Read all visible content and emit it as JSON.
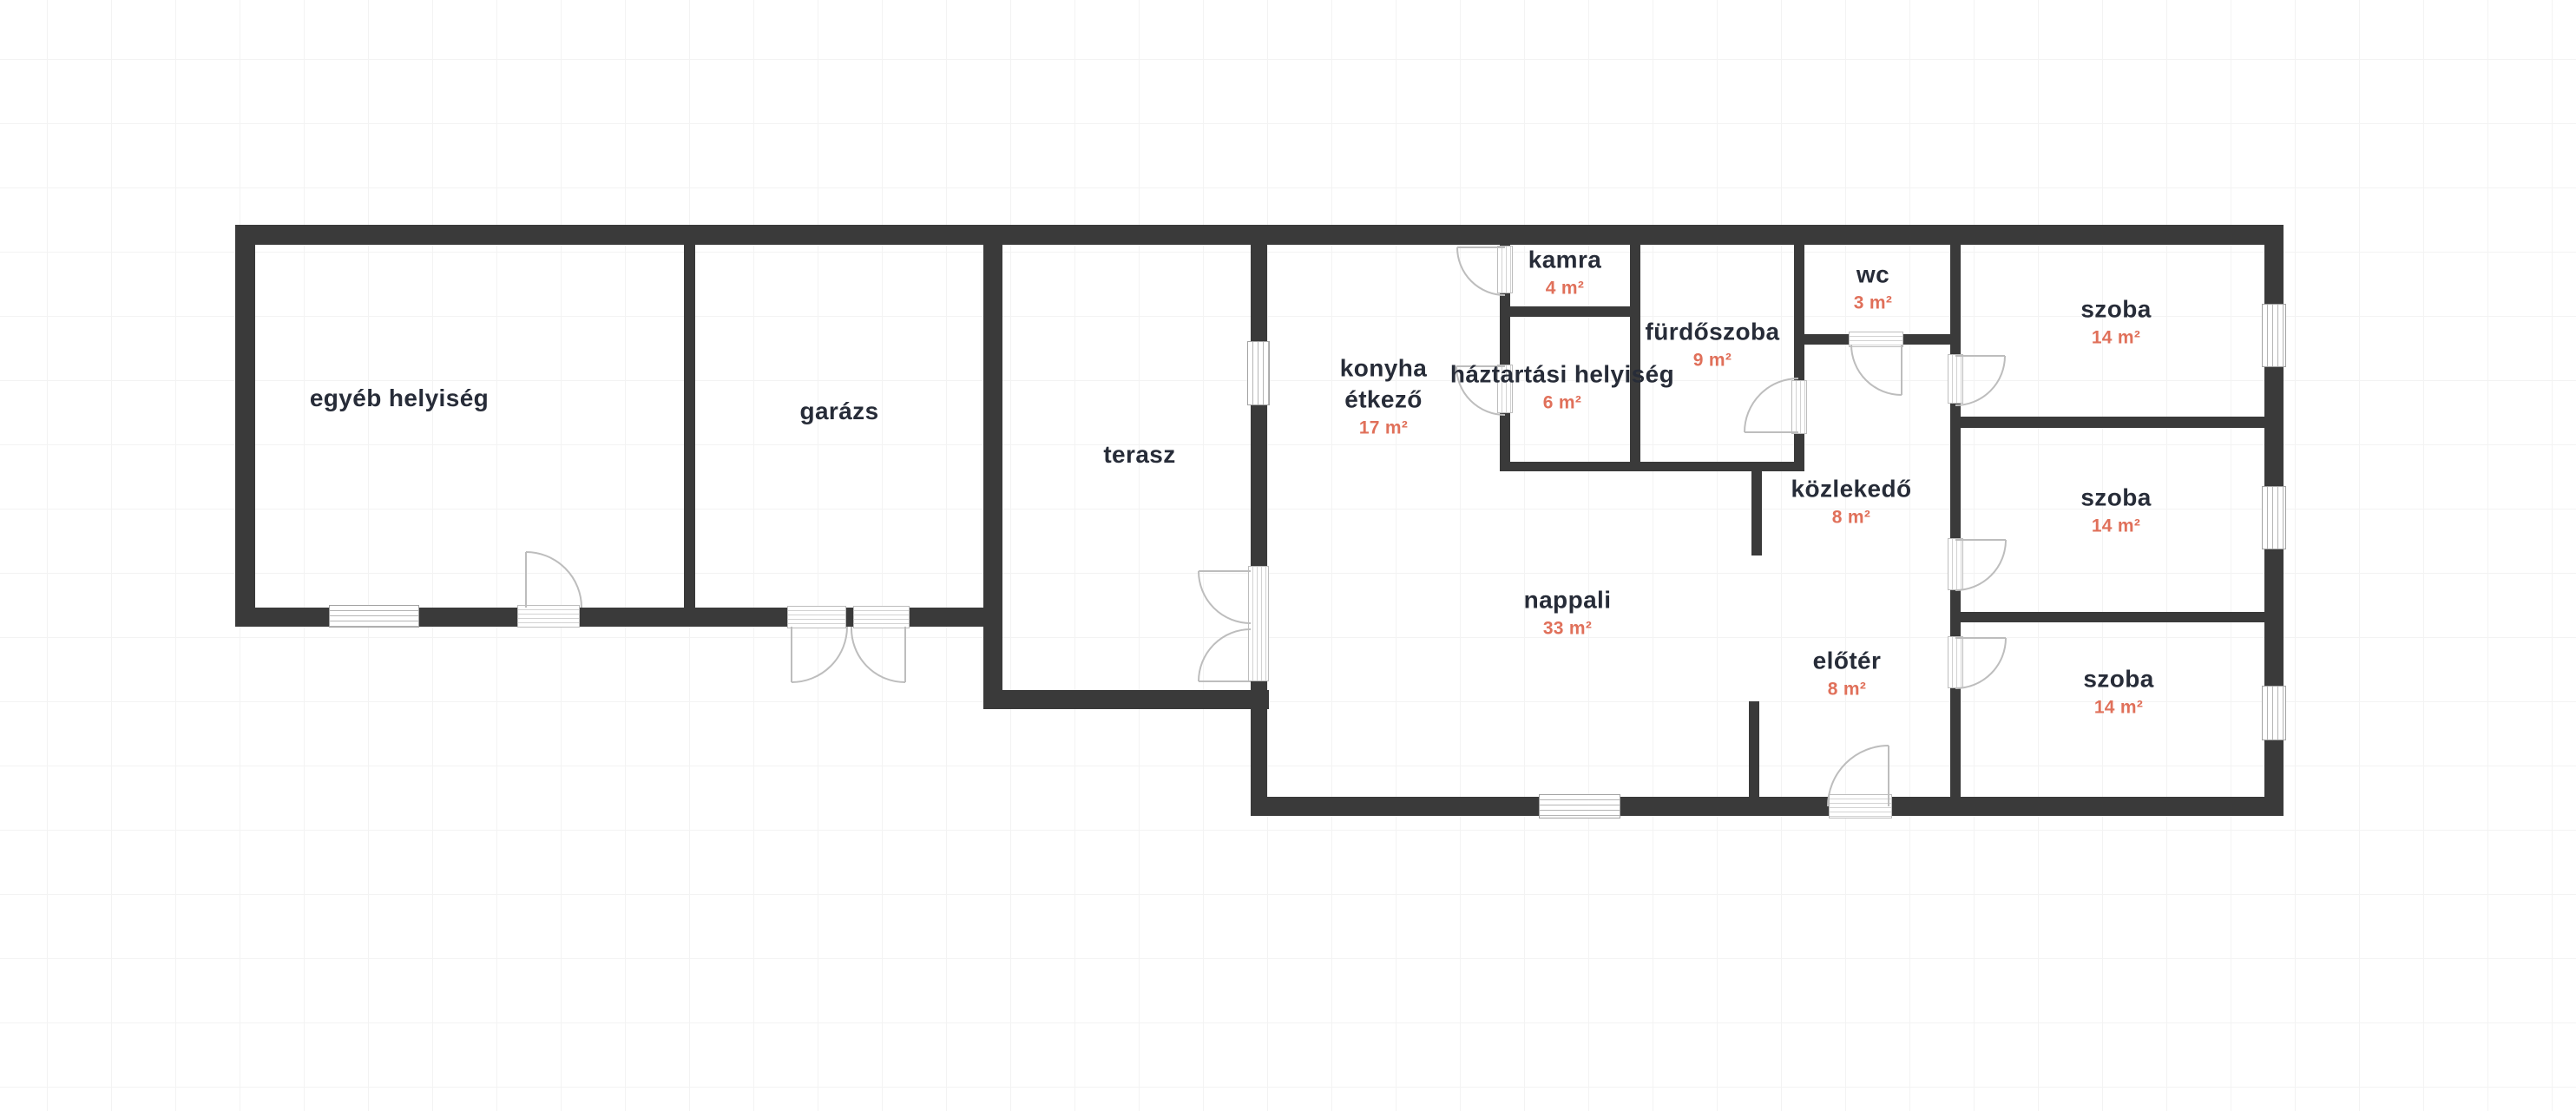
{
  "plan": {
    "title": "floor-plan",
    "language": "hu",
    "colors": {
      "wall": "#3a3a3a",
      "room_label": "#272c38",
      "area_label": "#e0705a",
      "grid_line": "#f3f3f3",
      "background": "#ffffff",
      "door_arc": "#bdbdbd",
      "window_frame": "#a3a3a3"
    },
    "symbols": {
      "door": "door-swing-icon",
      "window": "window-icon",
      "threshold": "door-threshold-icon"
    }
  },
  "rooms": [
    {
      "name": "egyéb helyiség",
      "area": ""
    },
    {
      "name": "garázs",
      "area": ""
    },
    {
      "name": "terasz",
      "area": ""
    },
    {
      "name": "konyha",
      "subname": "étkező",
      "area": "17 m²"
    },
    {
      "name": "kamra",
      "area": "4 m²"
    },
    {
      "name": "háztartási helyiség",
      "area": "6 m²"
    },
    {
      "name": "fürdőszoba",
      "area": "9 m²"
    },
    {
      "name": "wc",
      "area": "3 m²"
    },
    {
      "name": "szoba",
      "area": "14 m²"
    },
    {
      "name": "közlekedő",
      "area": "8 m²"
    },
    {
      "name": "nappali",
      "area": "33 m²"
    },
    {
      "name": "előtér",
      "area": "8 m²"
    },
    {
      "name": "szoba",
      "area": "14 m²"
    },
    {
      "name": "szoba",
      "area": "14 m²"
    }
  ]
}
